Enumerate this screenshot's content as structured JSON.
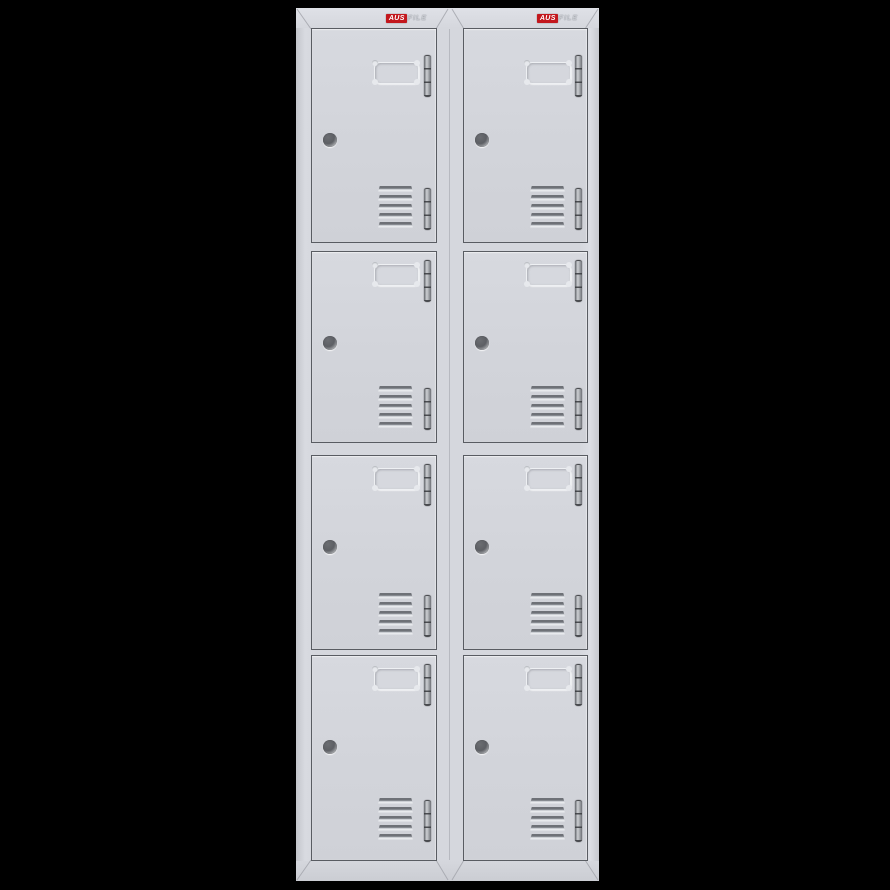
{
  "scene": {
    "background_color": "#000000"
  },
  "brand": {
    "primary": "AUS",
    "secondary": "FILE",
    "badge_color": "#c3171d",
    "primary_text_color": "#ffffff",
    "secondary_text_color": "#c9ccd2"
  },
  "cabinet": {
    "body_color": "#d5d7dd",
    "door_outline_color": "#595c62",
    "hinge_color": "#9a9da2",
    "columns": 2,
    "rows": 4,
    "total_doors": 8,
    "door_features": [
      "recessed-handle",
      "cam-lock",
      "vent-slats",
      "hinge-top",
      "hinge-bottom"
    ],
    "vent_slats_per_door": 5
  }
}
